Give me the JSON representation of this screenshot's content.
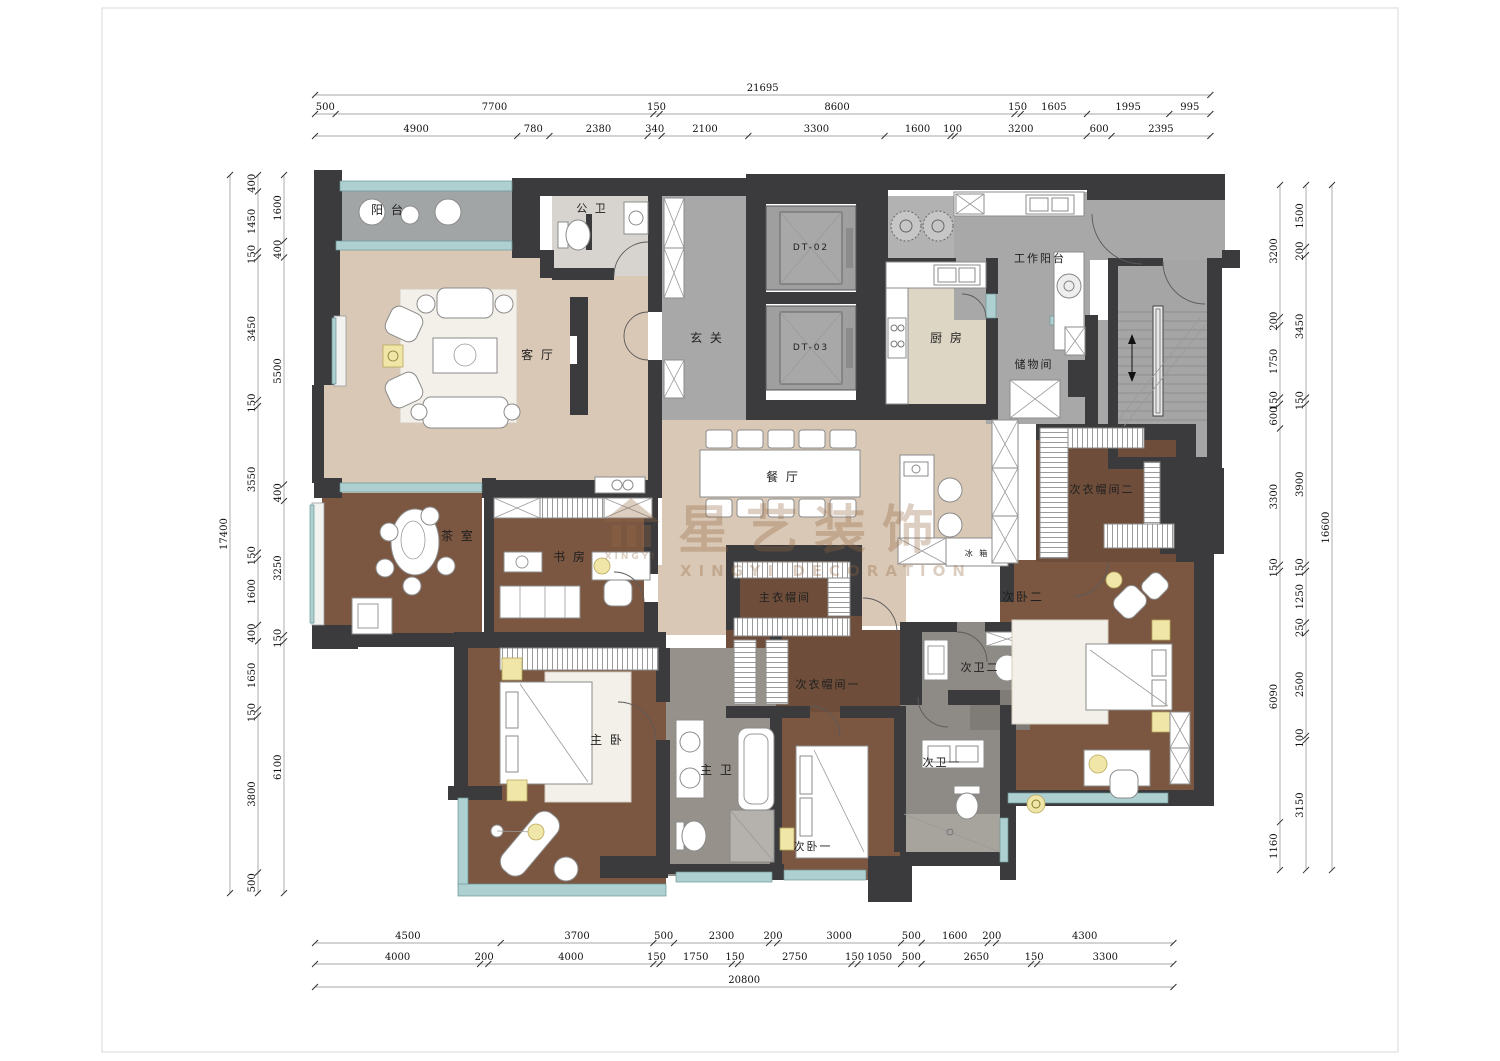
{
  "watermark": {
    "brand_cn": "星艺装饰",
    "brand_en": "XINGYI DECORATION",
    "logo_text": "XINGYI"
  },
  "colors": {
    "wall": "#3b3b3d",
    "floor_public_gray": "#a8a8a8",
    "floor_living_beige": "#d9c8b6",
    "floor_kitchen": "#ded6c5",
    "floor_wood": "#7b5742",
    "floor_wood_dark": "#6e4d3a",
    "floor_bath": "#8e8a85",
    "window_teal": "#aed0d0",
    "accent_yellow": "#f0e6a8",
    "watermark_brown": "rgba(150,104,66,0.32)"
  },
  "rooms": [
    {
      "id": "balcony",
      "label": "阳 台",
      "x": 388,
      "y": 214,
      "size": 12
    },
    {
      "id": "guest-bath",
      "label": "公 卫",
      "x": 592,
      "y": 212,
      "size": 11
    },
    {
      "id": "foyer",
      "label": "玄 关",
      "x": 707,
      "y": 342,
      "size": 12
    },
    {
      "id": "living-room",
      "label": "客 厅",
      "x": 538,
      "y": 359,
      "size": 12
    },
    {
      "id": "elevator-dt02",
      "label": "DT-02",
      "x": 811,
      "y": 250,
      "size": 9
    },
    {
      "id": "elevator-dt03",
      "label": "DT-03",
      "x": 811,
      "y": 350,
      "size": 9
    },
    {
      "id": "kitchen",
      "label": "厨 房",
      "x": 947,
      "y": 342,
      "size": 12
    },
    {
      "id": "work-balcony",
      "label": "工作阳台",
      "x": 1040,
      "y": 262,
      "size": 11
    },
    {
      "id": "storage",
      "label": "储物间",
      "x": 1034,
      "y": 368,
      "size": 11
    },
    {
      "id": "dining-room",
      "label": "餐 厅",
      "x": 783,
      "y": 481,
      "size": 12
    },
    {
      "id": "fridge",
      "label": "冰 箱",
      "x": 977,
      "y": 556,
      "size": 8
    },
    {
      "id": "tea-room",
      "label": "茶 室",
      "x": 458,
      "y": 540,
      "size": 12
    },
    {
      "id": "study",
      "label": "书 房",
      "x": 570,
      "y": 561,
      "size": 12
    },
    {
      "id": "master-closet",
      "label": "主衣帽间",
      "x": 785,
      "y": 601,
      "size": 11
    },
    {
      "id": "closet-2",
      "label": "次衣帽间二",
      "x": 1102,
      "y": 493,
      "size": 11
    },
    {
      "id": "bedroom-2",
      "label": "次卧二",
      "x": 1023,
      "y": 601,
      "size": 12
    },
    {
      "id": "bath-2",
      "label": "次卫二",
      "x": 980,
      "y": 671,
      "size": 11
    },
    {
      "id": "closet-1",
      "label": "次衣帽间一",
      "x": 828,
      "y": 688,
      "size": 11
    },
    {
      "id": "master-bedroom",
      "label": "主 卧",
      "x": 607,
      "y": 744,
      "size": 12
    },
    {
      "id": "master-bath",
      "label": "主 卫",
      "x": 717,
      "y": 774,
      "size": 12
    },
    {
      "id": "bath-1",
      "label": "次卫一",
      "x": 942,
      "y": 766,
      "size": 11
    },
    {
      "id": "bedroom-1",
      "label": "次卧一",
      "x": 813,
      "y": 850,
      "size": 11
    }
  ],
  "dimensions": {
    "scale_px_per_mm": 0.04127,
    "top": {
      "x0": 315,
      "rows": [
        {
          "y": 88,
          "values": [
            21695
          ]
        },
        {
          "y": 107,
          "values": [
            500,
            7700,
            150,
            8600,
            150,
            1605,
            1995,
            995
          ]
        },
        {
          "y": 129,
          "values": [
            4900,
            780,
            2380,
            340,
            2100,
            3300,
            1600,
            100,
            3200,
            600,
            2395
          ]
        }
      ]
    },
    "bottom": {
      "x0": 315,
      "rows": [
        {
          "y": 936,
          "values": [
            4500,
            3700,
            500,
            2300,
            200,
            3000,
            500,
            1600,
            200,
            4300
          ]
        },
        {
          "y": 957,
          "values": [
            4000,
            200,
            4000,
            150,
            1750,
            150,
            2750,
            150,
            1050,
            500,
            2650,
            150,
            3300
          ]
        },
        {
          "y": 980,
          "values": [
            20800
          ]
        }
      ]
    },
    "left": {
      "y0": 175,
      "cols": [
        {
          "x": 222,
          "values": [
            17400
          ]
        },
        {
          "x": 250,
          "values": [
            400,
            1450,
            150,
            3450,
            150,
            3550,
            150,
            1600,
            400,
            1650,
            150,
            3800,
            500
          ]
        },
        {
          "x": 276,
          "values": [
            1600,
            400,
            5500,
            400,
            3250,
            150,
            6100
          ]
        }
      ]
    },
    "right": {
      "y0": 185,
      "cols": [
        {
          "x": 1272,
          "values": [
            3200,
            200,
            1750,
            150,
            600,
            3300,
            150,
            6090,
            1160
          ]
        },
        {
          "x": 1298,
          "values": [
            1500,
            200,
            3450,
            150,
            3900,
            150,
            1250,
            250,
            2500,
            100,
            3150
          ]
        },
        {
          "x": 1324,
          "values": [
            16600
          ]
        }
      ]
    }
  }
}
